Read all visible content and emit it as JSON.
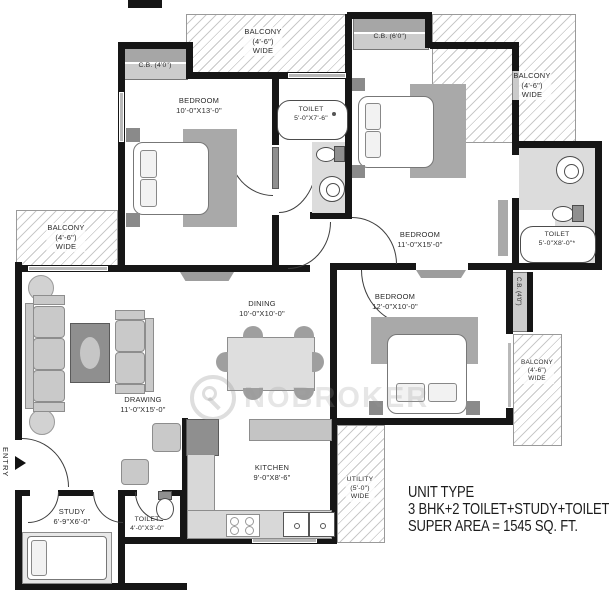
{
  "rooms": {
    "bedroom1": {
      "name": "BEDROOM",
      "dims": "10'-0\"X13'-0\""
    },
    "bedroom2": {
      "name": "BEDROOM",
      "dims": "11'-0\"X15'-0\""
    },
    "bedroom3": {
      "name": "BEDROOM",
      "dims": "12'-0\"X10'-0\""
    },
    "drawing": {
      "name": "DRAWING",
      "dims": "11'-0\"X15'-0\""
    },
    "dining": {
      "name": "DINING",
      "dims": "10'-0\"X10'-0\""
    },
    "kitchen": {
      "name": "KITCHEN",
      "dims": "9'-0\"X8'-6\""
    },
    "study": {
      "name": "STUDY",
      "dims": "6'-9\"X6'-0\""
    },
    "toilet_mid": {
      "name": "TOILET",
      "dims": "5'-0\"X7'-6\""
    },
    "toilet_right": {
      "name": "TOILET",
      "dims": "5'-0\"X8'-0\"*"
    },
    "toilet_small": {
      "name": "TOILET",
      "dims": "4'-0\"X3'-0\""
    },
    "utility": {
      "name": "UTILITY",
      "dims": "(5'-0\")",
      "wide": "WIDE"
    }
  },
  "balconies": {
    "top_left": {
      "name": "BALCONY",
      "dims": "(4'-6\")",
      "wide": "WIDE"
    },
    "top_right": {
      "name": "BALCONY",
      "dims": "(4'-6\")",
      "wide": "WIDE"
    },
    "left": {
      "name": "BALCONY",
      "dims": "(4'-6\")",
      "wide": "WIDE"
    },
    "right": {
      "name": "BALCONY",
      "dims": "(4'-6\")",
      "wide": "WIDE"
    }
  },
  "cupboards": {
    "cb_top_left": "C.B. (4'0\")",
    "cb_top_middle": "C.B. (6'0\")",
    "cb_right": "C.B. (4'0\")"
  },
  "entry": {
    "label": "ENTRY"
  },
  "watermark": {
    "text": "NOBROKER"
  },
  "unit_info": {
    "line1": "UNIT TYPE",
    "line2": "3 BHK+2 TOILET+STUDY+TOILET",
    "line3": "SUPER AREA = 1545 SQ. FT."
  },
  "colors": {
    "wall": "#161616",
    "furniture": "#c9c9c9",
    "hatch_line": "#c9c9c9",
    "text": "#2b2b2b"
  }
}
